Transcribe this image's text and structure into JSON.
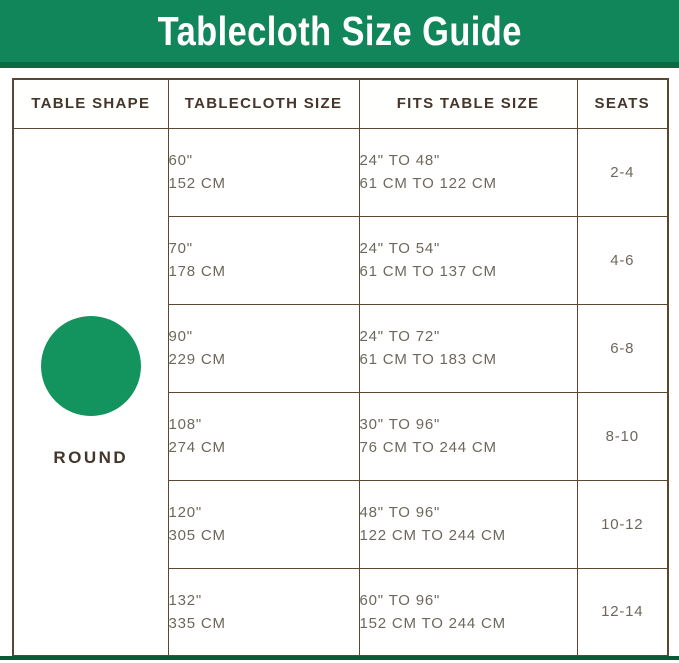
{
  "title": "Tablecloth Size Guide",
  "colors": {
    "banner_green": "#11865A",
    "banner_edge_green": "#0A6B41",
    "circle_green": "#13945F",
    "border_brown": "#5A4733",
    "header_text": "#46352A",
    "body_text": "#6E675D",
    "bottom_bar_green": "#0A5A36"
  },
  "table": {
    "headers": [
      "TABLE SHAPE",
      "TABLECLOTH SIZE",
      "FITS TABLE SIZE",
      "SEATS"
    ],
    "shape_label": "ROUND",
    "rows": [
      {
        "size_in": "60\"",
        "size_cm": "152 CM",
        "fits_in": "24\" TO 48\"",
        "fits_cm": "61 CM TO 122 CM",
        "seats": "2-4"
      },
      {
        "size_in": "70\"",
        "size_cm": "178 CM",
        "fits_in": "24\" TO 54\"",
        "fits_cm": "61 CM TO 137 CM",
        "seats": "4-6"
      },
      {
        "size_in": "90\"",
        "size_cm": "229 CM",
        "fits_in": "24\" TO 72\"",
        "fits_cm": "61 CM TO 183 CM",
        "seats": "6-8"
      },
      {
        "size_in": "108\"",
        "size_cm": "274 CM",
        "fits_in": "30\" TO 96\"",
        "fits_cm": "76 CM TO 244 CM",
        "seats": "8-10"
      },
      {
        "size_in": "120\"",
        "size_cm": "305 CM",
        "fits_in": "48\" TO 96\"",
        "fits_cm": "122 CM TO 244 CM",
        "seats": "10-12"
      },
      {
        "size_in": "132\"",
        "size_cm": "335 CM",
        "fits_in": "60\" TO 96\"",
        "fits_cm": "152 CM TO 244 CM",
        "seats": "12-14"
      }
    ]
  },
  "chart_data": {
    "type": "table",
    "title": "Tablecloth Size Guide",
    "columns": [
      "TABLE SHAPE",
      "TABLECLOTH SIZE",
      "FITS TABLE SIZE",
      "SEATS"
    ],
    "rows": [
      [
        "ROUND",
        "60\" / 152 CM",
        "24\" TO 48\" / 61 CM TO 122 CM",
        "2-4"
      ],
      [
        "ROUND",
        "70\" / 178 CM",
        "24\" TO 54\" / 61 CM TO 137 CM",
        "4-6"
      ],
      [
        "ROUND",
        "90\" / 229 CM",
        "24\" TO 72\" / 61 CM TO 183 CM",
        "6-8"
      ],
      [
        "ROUND",
        "108\" / 274 CM",
        "30\" TO 96\" / 76 CM TO 244 CM",
        "8-10"
      ],
      [
        "ROUND",
        "120\" / 305 CM",
        "48\" TO 96\" / 122 CM TO 244 CM",
        "10-12"
      ],
      [
        "ROUND",
        "132\" / 335 CM",
        "60\" TO 96\" / 152 CM TO 244 CM",
        "12-14"
      ]
    ]
  }
}
